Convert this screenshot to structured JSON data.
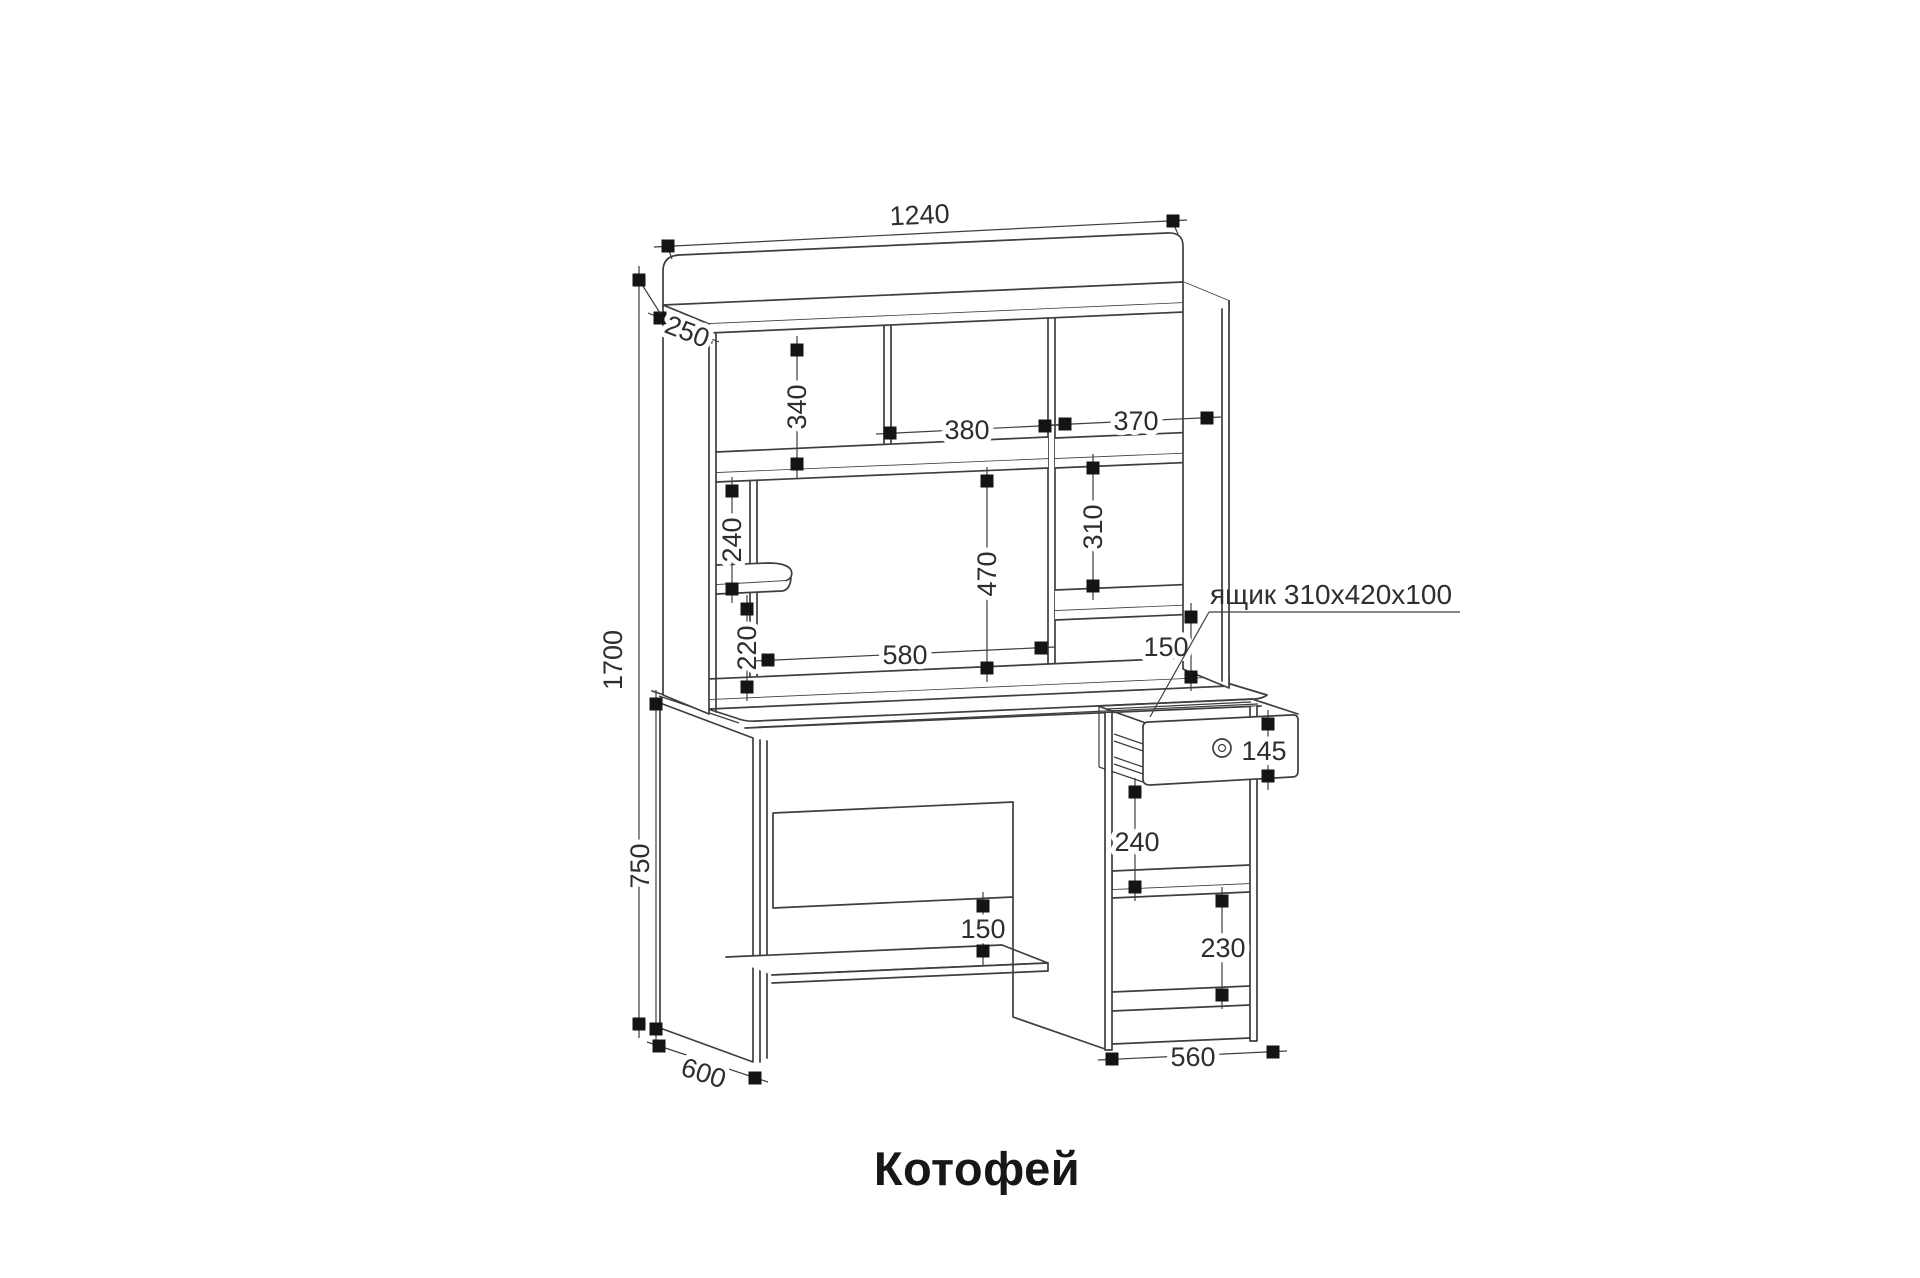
{
  "drawing": {
    "title": "Котофей",
    "type": "furniture dimension diagram (computer desk with hutch)"
  },
  "dims": {
    "total_width": "1240",
    "hutch_depth": "250",
    "total_height": "1700",
    "hutch_left_opening": "340",
    "hutch_mid_opening_w": "380",
    "hutch_right_opening_w": "370",
    "hutch_left_shelf_gap": "240",
    "hutch_center_opening_h": "470",
    "hutch_right_shelf_gap": "310",
    "hutch_left_bottom_gap": "220",
    "hutch_center_opening_w": "580",
    "hutch_right_bottom_gap": "150",
    "desk_height": "750",
    "desk_depth": "600",
    "knee_shelf_gap": "150",
    "cabinet_top_gap": "240",
    "cabinet_bottom_gap": "230",
    "drawer_front_h": "145",
    "cabinet_width": "560"
  },
  "labels": {
    "drawer_note": "ящик 310x420x100",
    "title": "Котофей"
  }
}
